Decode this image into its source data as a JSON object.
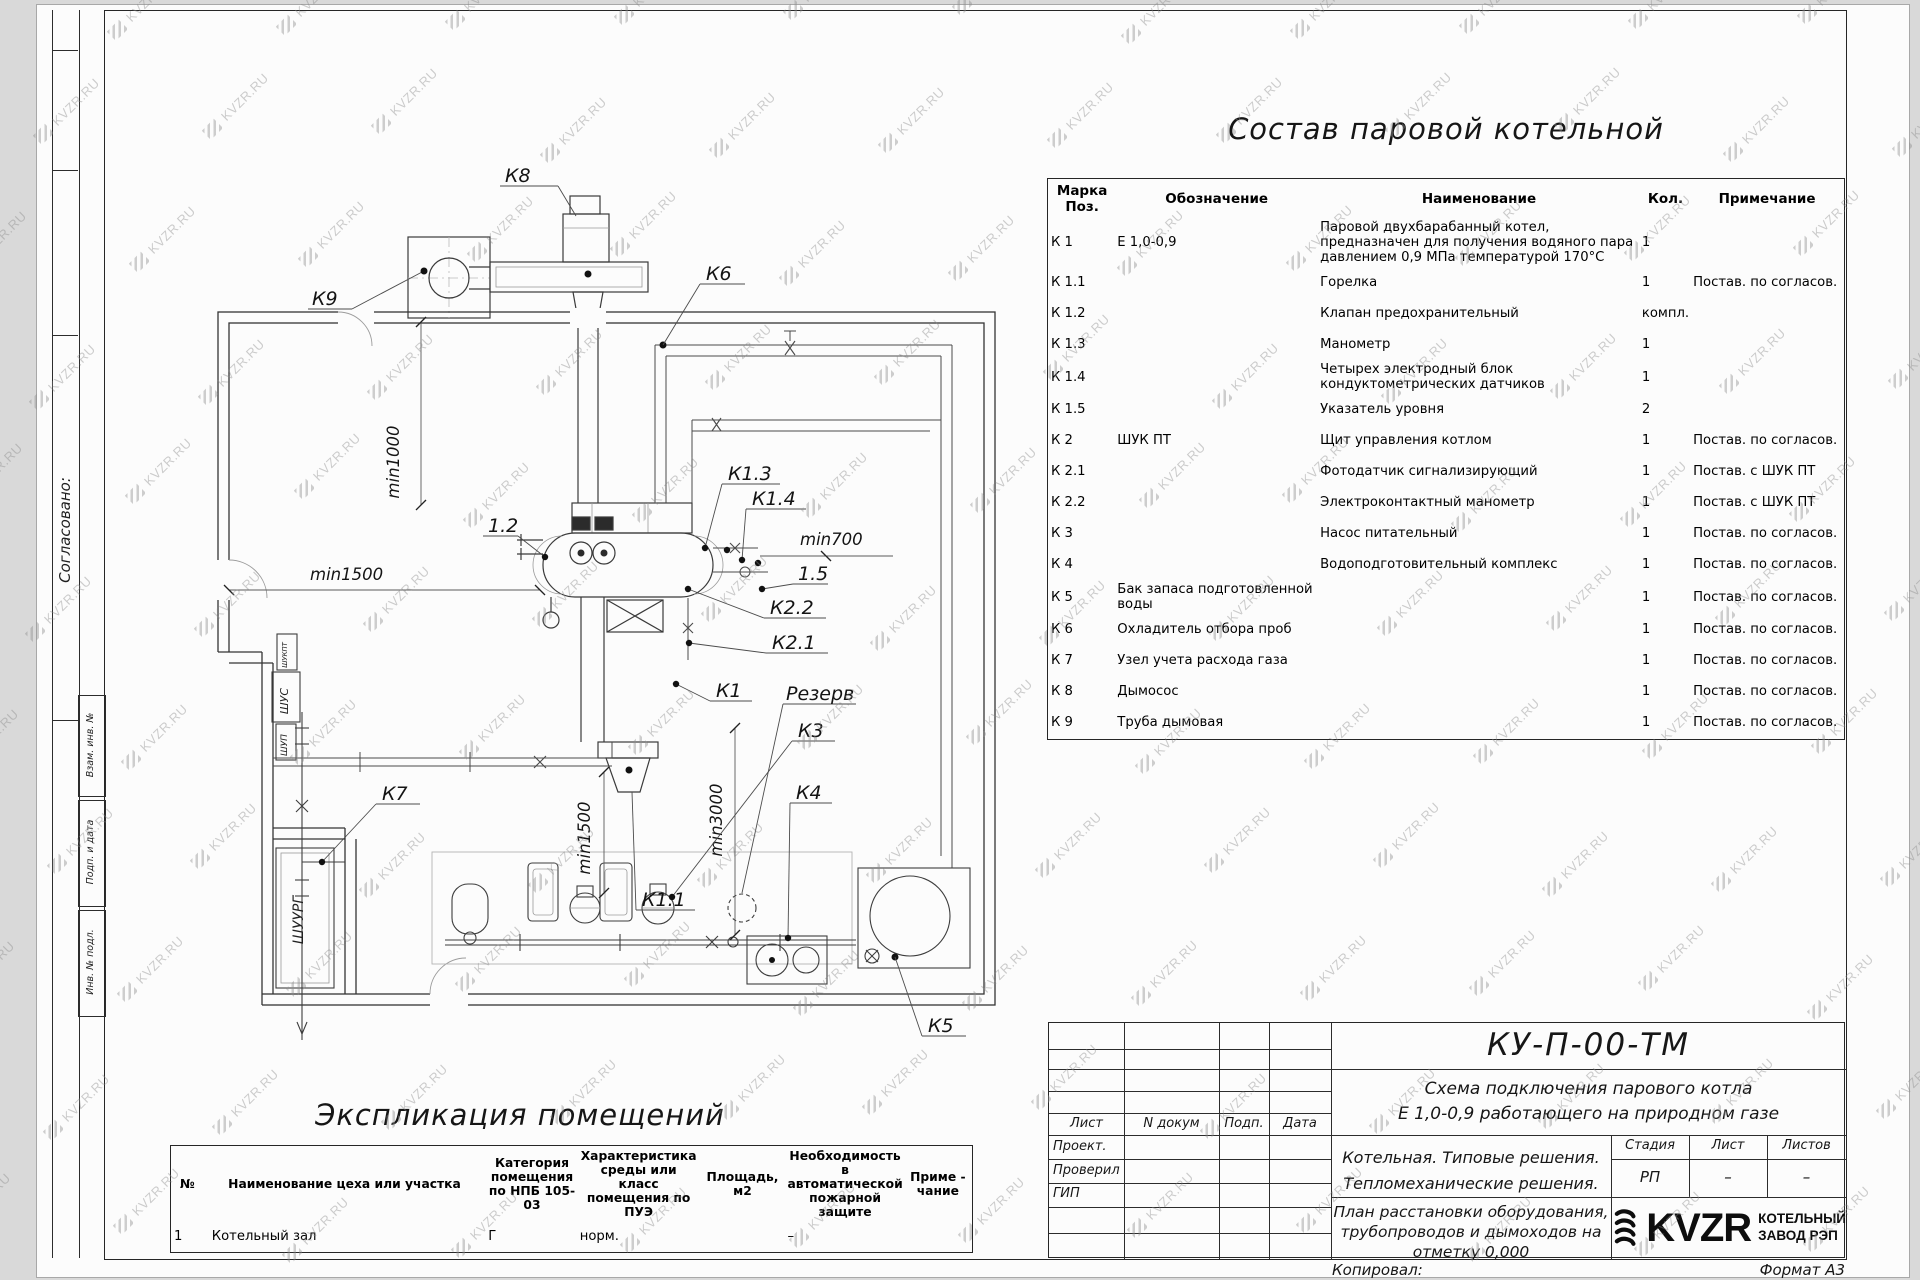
{
  "watermark": {
    "text": "KVZR.RU"
  },
  "side_panel": {
    "agreed": "Согласовано:",
    "stamps": [
      "Взам. инв. №",
      "Подп. и дата",
      "Инв. № подл."
    ]
  },
  "composition_table": {
    "title": "Состав паровой котельной",
    "headers": [
      "Марка Поз.",
      "Обозначение",
      "Наименование",
      "Кол.",
      "Примечание"
    ],
    "rows": [
      [
        "К 1",
        "Е 1,0-0,9",
        "Паровой двухбарабанный котел, предназначен для получения водяного пара давлением 0,9 МПа температурой 170°С",
        "1",
        ""
      ],
      [
        "К 1.1",
        "",
        "Горелка",
        "1",
        "Постав. по согласов."
      ],
      [
        "К 1.2",
        "",
        "Клапан предохранительный",
        "компл.",
        ""
      ],
      [
        "К 1.3",
        "",
        "Манометр",
        "1",
        ""
      ],
      [
        "К 1.4",
        "",
        "Четырех электродный блок кондуктометрических датчиков",
        "1",
        ""
      ],
      [
        "К 1.5",
        "",
        "Указатель уровня",
        "2",
        ""
      ],
      [
        "К 2",
        "ШУК ПТ",
        "Щит управления котлом",
        "1",
        "Постав. по согласов."
      ],
      [
        "К 2.1",
        "",
        "Фотодатчик сигнализирующий",
        "1",
        "Постав. с ШУК ПТ"
      ],
      [
        "К 2.2",
        "",
        "Электроконтактный манометр",
        "1",
        "Постав. с ШУК ПТ"
      ],
      [
        "К 3",
        "",
        "Насос питательный",
        "1",
        "Постав. по согласов."
      ],
      [
        "К 4",
        "",
        "Водоподготовительный комплекс",
        "1",
        "Постав. по согласов."
      ],
      [
        "К 5",
        "Бак запаса подготовленной воды",
        "",
        "1",
        "Постав. по согласов."
      ],
      [
        "К 6",
        "Охладитель отбора проб",
        "",
        "1",
        "Постав. по согласов."
      ],
      [
        "К 7",
        "Узел учета расхода газа",
        "",
        "1",
        "Постав. по согласов."
      ],
      [
        "К 8",
        "Дымосос",
        "",
        "1",
        "Постав. по согласов."
      ],
      [
        "К 9",
        "Труба дымовая",
        "",
        "1",
        "Постав. по согласов."
      ]
    ]
  },
  "explication_table": {
    "title": "Экспликация помещений",
    "headers": [
      "№",
      "Наименование цеха или участка",
      "Категория помещения по НПБ 105-03",
      "Характеристика среды или класс помещения по ПУЭ",
      "Площадь, м2",
      "Необходимость в автоматической пожарной защите",
      "Приме - чание"
    ],
    "rows": [
      [
        "1",
        "Котельный зал",
        "Г",
        "норм.",
        "",
        "–",
        ""
      ]
    ]
  },
  "title_block": {
    "doc_code": "КУ-П-00-ТМ",
    "subtitle_line1": "Схема подключения парового котла",
    "subtitle_line2": "Е 1,0-0,9  работающего на природном газе",
    "header_row": [
      "Лист",
      "N докум",
      "Подп.",
      "Дата"
    ],
    "role_rows": [
      "Проект.",
      "Проверил",
      "ГИП"
    ],
    "project_line1": "Котельная. Типовые решения.",
    "project_line2": "Тепломеханические решения.",
    "stage_label": "Стадия",
    "sheet_label": "Лист",
    "sheets_label": "Листов",
    "stage_value": "РП",
    "sheet_value": "–",
    "sheets_value": "–",
    "drawing_line1": "План расстановки оборудования,",
    "drawing_line2": "трубопроводов и дымоходов на",
    "drawing_line3": "отметку 0,000",
    "logo_text": "KVZR",
    "company_line1": "КОТЕЛЬНЫЙ",
    "company_line2": "ЗАВОД РЭП",
    "copied_label": "Копировал:",
    "format_label": "Формат А3"
  },
  "plan": {
    "labels": {
      "k8": "К8",
      "k9": "К9",
      "k6": "К6",
      "k7": "К7",
      "k1": "К1",
      "k1_1": "К1.1",
      "k1_3": "К1.3",
      "k1_4": "К1.4",
      "k2_1": "К2.1",
      "k2_2": "К2.2",
      "k3": "К3",
      "k4": "К4",
      "k5": "К5",
      "rezerv": "Резерв",
      "pos1_2": "1.2",
      "pos1_5": "1.5",
      "min1000": "min1000",
      "min1500_left": "min1500",
      "min1500_bottom": "min1500",
      "min3000": "min3000",
      "min700": "min700"
    },
    "cabinets": {
      "shukpt": "ШУКПТ",
      "shus": "ШУС",
      "shup": "ШУП",
      "shuurg": "ШУУРГ"
    }
  }
}
